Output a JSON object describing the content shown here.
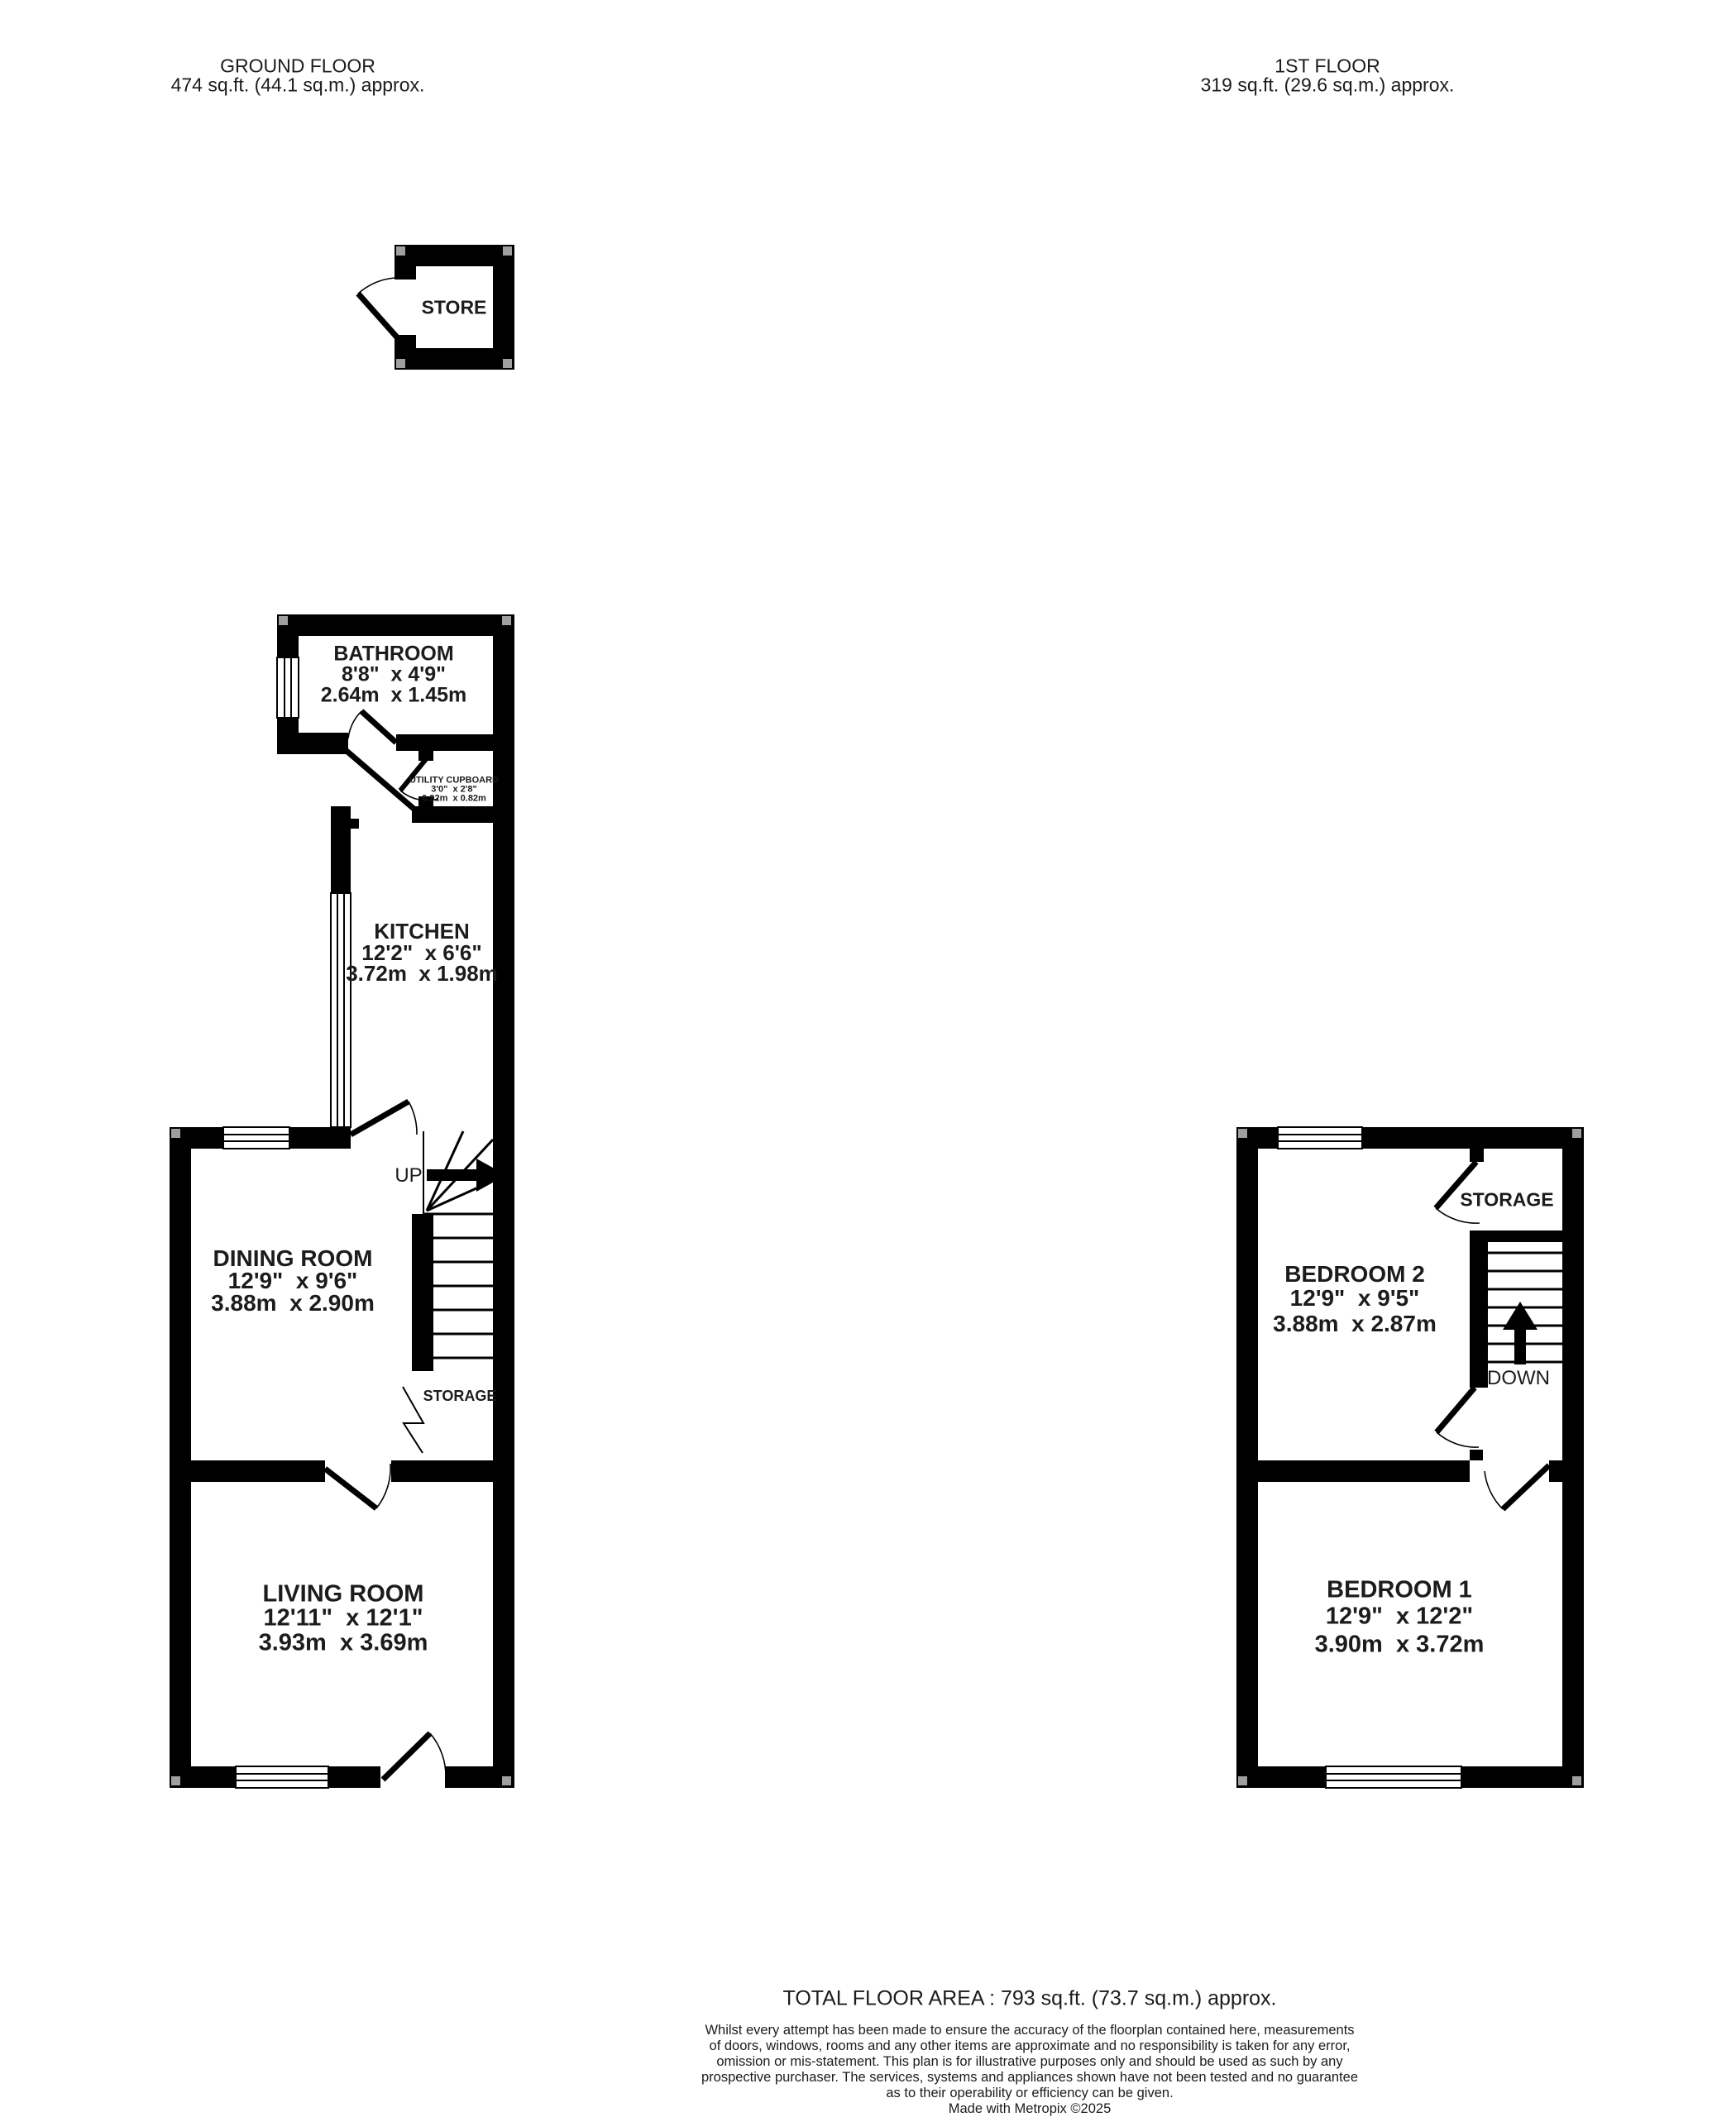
{
  "ground_floor_header": {
    "title": "GROUND FLOOR",
    "area": "474 sq.ft. (44.1 sq.m.) approx."
  },
  "first_floor_header": {
    "title": "1ST FLOOR",
    "area": "319 sq.ft. (29.6 sq.m.) approx."
  },
  "rooms": {
    "store": {
      "name": "STORE"
    },
    "bathroom": {
      "name": "BATHROOM",
      "imperial": "8'8\"  x 4'9\"",
      "metric": "2.64m  x 1.45m"
    },
    "utility_cupboard": {
      "name": "UTILITY CUPBOARD",
      "imperial": "3'0\"  x 2'8\"",
      "metric": "0.92m  x 0.82m"
    },
    "kitchen": {
      "name": "KITCHEN",
      "imperial": "12'2\"  x 6'6\"",
      "metric": "3.72m  x 1.98m"
    },
    "dining_room": {
      "name": "DINING ROOM",
      "imperial": "12'9\"  x 9'6\"",
      "metric": "3.88m  x 2.90m"
    },
    "living_room": {
      "name": "LIVING ROOM",
      "imperial": "12'11\"  x 12'1\"",
      "metric": "3.93m  x 3.69m"
    },
    "bedroom_2": {
      "name": "BEDROOM 2",
      "imperial": "12'9\"  x 9'5\"",
      "metric": "3.88m  x 2.87m"
    },
    "bedroom_1": {
      "name": "BEDROOM 1",
      "imperial": "12'9\"  x 12'2\"",
      "metric": "3.90m  x 3.72m"
    }
  },
  "annotations": {
    "up": "UP",
    "down": "DOWN",
    "storage_under_stairs": "STORAGE",
    "storage_first_floor": "STORAGE"
  },
  "footer": {
    "total_area": "TOTAL FLOOR AREA : 793 sq.ft. (73.7 sq.m.) approx.",
    "disclaimer_lines": [
      "Whilst every attempt has been made to ensure the accuracy of the floorplan contained here, measurements",
      "of doors, windows, rooms and any other items are approximate and no responsibility is taken for any error,",
      "omission or mis-statement. This plan is for illustrative purposes only and should be used as such by any",
      "prospective purchaser. The services, systems and appliances shown have not been tested and no guarantee",
      "as to their operability or efficiency can be given."
    ],
    "credit": "Made with Metropix ©2025"
  },
  "colors": {
    "wall": "#000000",
    "text": "#1c1c1c",
    "background": "#ffffff"
  }
}
